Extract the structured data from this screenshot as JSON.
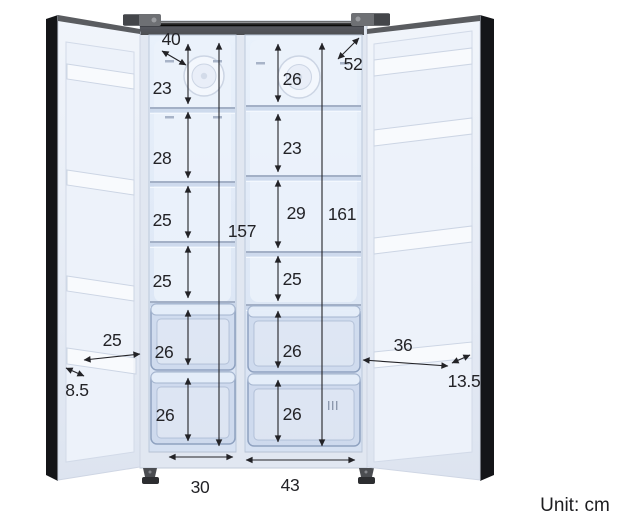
{
  "figure": {
    "unit_label": "Unit: cm"
  },
  "annotations": {
    "top_left_depth": "40",
    "top_right_depth": "52",
    "left_column": {
      "sections": [
        "23",
        "28",
        "25",
        "25",
        "26",
        "26"
      ],
      "total_height": "157",
      "bottom_width": "30"
    },
    "right_column": {
      "sections": [
        "26",
        "23",
        "29",
        "25",
        "26",
        "26"
      ],
      "total_height": "161",
      "bottom_width": "43",
      "drawer_mark": "III"
    },
    "left_door_shelf": {
      "width": "25",
      "depth": "8.5"
    },
    "right_door_shelf": {
      "width": "36",
      "depth": "13.5"
    }
  },
  "colors": {
    "liner_blue": "#dfe8f6",
    "door_edge_black": "#141518",
    "top_frame_gray": "#5b5d61",
    "annotation_ink": "#232327",
    "background": "#ffffff"
  }
}
